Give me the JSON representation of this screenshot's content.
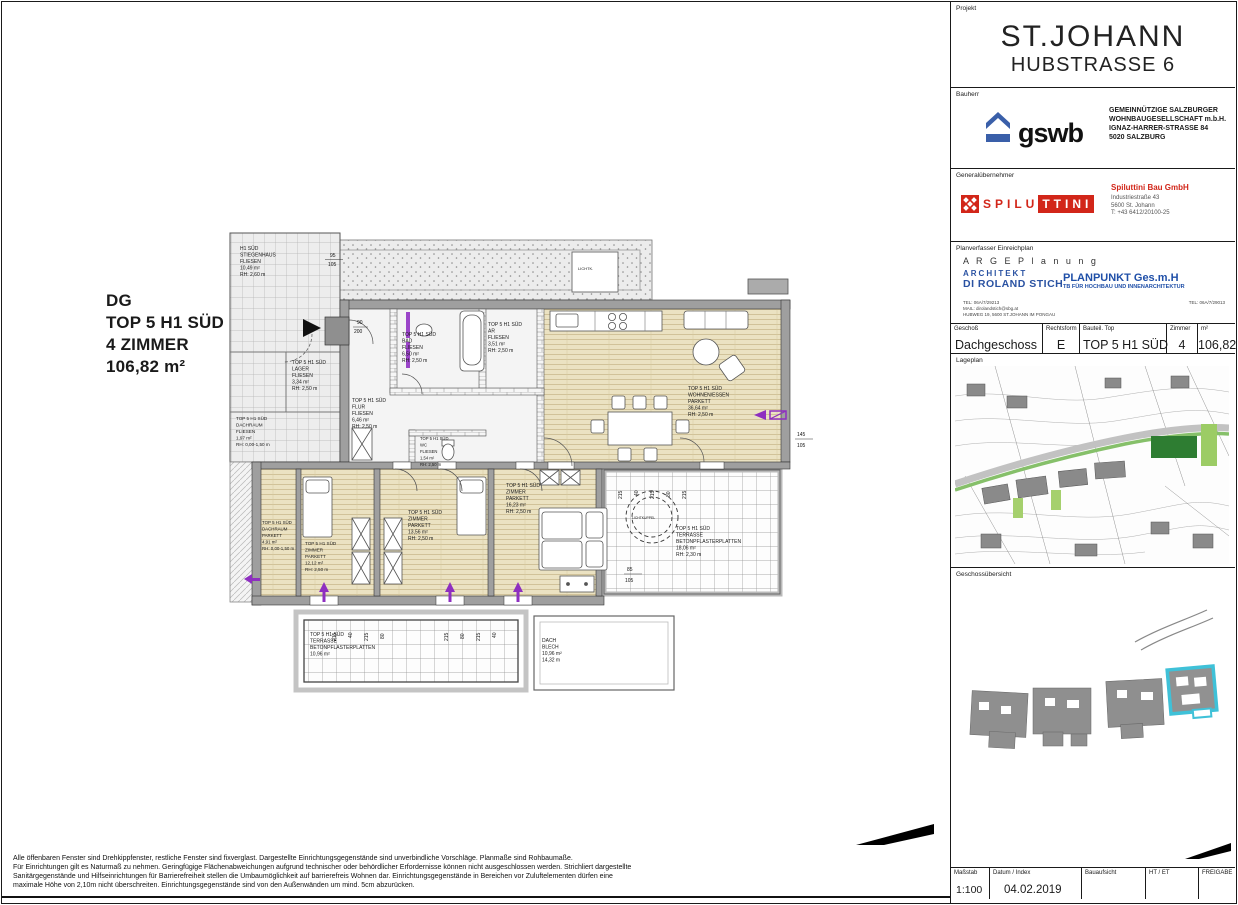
{
  "sheet": {
    "projekt": {
      "label": "Projekt",
      "title": "ST.JOHANN",
      "subtitle": "HUBSTRASSE 6"
    },
    "bauherr": {
      "label": "Bauherr",
      "logo": "gswb",
      "address": [
        "GEMEINNÜTZIGE SALZBURGER",
        "WOHNBAUGESELLSCHAFT m.b.H.",
        "IGNAZ-HARRER-STRASSE 84",
        "5020 SALZBURG"
      ]
    },
    "generaluebernehmer": {
      "label": "Generalübernehmer",
      "logo_left": "SPILU",
      "logo_right": "TTINI",
      "company": "Spiluttini Bau GmbH",
      "address": [
        "Industriestraße 43",
        "5600 St. Johann",
        "T: +43 6412/20100-25"
      ]
    },
    "planverfasser": {
      "label": "Planverfasser Einreichplan",
      "arge": "A R G E   P l a n u n g",
      "architekt": "ARCHITEKT",
      "architekt_name": "DI ROLAND STICH",
      "firma": "PLANPUNKT Ges.m.H",
      "firma_sub": "TB FÜR HOCHBAU UND INNENARCHITEKTUR",
      "kontakt_links": [
        "TEL: 06A/7/29213",
        "MAIL: dirolandstich@sbg.at",
        "HUBWEG 19, 5600 ST.JOHANN IM PONGAU"
      ],
      "kontakt_rechts": "TEL: 06A/7/29013"
    },
    "einheit_tabelle": {
      "spalten": [
        "Geschoß",
        "Rechtsform",
        "Bauteil. Top",
        "Zimmer",
        "m²"
      ],
      "zeile": [
        "Dachgeschoss",
        "E",
        "TOP 5 H1 SÜD",
        "4",
        "106,82"
      ]
    },
    "lageplan_label": "Lageplan",
    "uebersicht_label": "Geschossübersicht",
    "info_tabelle": {
      "spalten": [
        {
          "label": "Maßstab",
          "wert": "1:100"
        },
        {
          "label": "Datum / Index",
          "wert": "04.02.2019"
        },
        {
          "label": "Bauaufsicht",
          "wert": ""
        },
        {
          "label": "HT / ET",
          "wert": ""
        },
        {
          "label": "FREIGABE",
          "wert": ""
        }
      ]
    }
  },
  "plan_titel": {
    "zeilen": [
      "DG",
      "TOP 5 H1 SÜD",
      "4 ZIMMER",
      "106,82 m²"
    ]
  },
  "hinweis": {
    "zeilen": [
      "Alle öffenbaren Fenster sind Drehkippfenster, restliche Fenster sind fixverglast. Dargestellte Einrichtungsgegenstände sind unverbindliche Vorschläge. Planmaße sind Rohbaumaße.",
      "Für Einrichtungen gilt es Naturmaß zu nehmen. Geringfügige Flächenabweichungen aufgrund technischer oder behördlicher Erfordernisse können nicht ausgeschlossen werden. Strichliert dargestellte",
      "Sanitärgegenstände und Hilfseinrichtungen für Barrierefreiheit stellen die Umbaumöglichkeit auf barrierefreis Wohnen dar. Einrichtungsgegenstände in Bereichen vor Zuluftelementen dürfen eine",
      "maximale Höhe von 2,10m nicht überschreiten. Einrichtungsgegenstände sind von den Außenwänden um mind. 5cm abzurücken."
    ]
  },
  "farben": {
    "wand": "#9f9f9f",
    "parkett": "#ebe2c2",
    "blau": "#1f4fa8",
    "rot": "#d22619",
    "violett": "#8e2fc0",
    "highlight_cyan": "#3fc1d8"
  },
  "plan": {
    "rooms": [
      {
        "x": 240,
        "y": 250,
        "lines": [
          "H1 SÜD",
          "STIEGENHAUS",
          "FLIESEN",
          "10,49 m²",
          "RH: 2,60 m"
        ]
      },
      {
        "x": 292,
        "y": 364,
        "lines": [
          "TOP 5 H1 SÜD",
          "LAGER",
          "FLIESEN",
          "3,34 m²",
          "RH: 2,50 m"
        ]
      },
      {
        "x": 236,
        "y": 420,
        "fs": 4.6,
        "lines": [
          "TOP 5 H1 SÜD",
          "DACHRAUM",
          "FLIESEN",
          "1,97 m²",
          "RH: 0,00-1,50 m"
        ]
      },
      {
        "x": 402,
        "y": 336,
        "lines": [
          "TOP 5 H1 SÜD",
          "BAD",
          "FLIESEN",
          "6,50 m²",
          "RH: 2,50 m"
        ]
      },
      {
        "x": 488,
        "y": 326,
        "lines": [
          "TOP 5 H1 SÜD",
          "AR",
          "FLIESEN",
          "3,51 m²",
          "RH: 2,50 m"
        ]
      },
      {
        "x": 352,
        "y": 402,
        "lines": [
          "TOP 5 H1 SÜD",
          "FLUR",
          "FLIESEN",
          "6,46 m²",
          "RH: 2,50 m"
        ]
      },
      {
        "x": 420,
        "y": 440,
        "fs": 4.2,
        "lines": [
          "TOP 5 H1 SÜD",
          "WC",
          "FLIESEN",
          "1,54 m²",
          "RH: 2,50 m"
        ]
      },
      {
        "x": 688,
        "y": 390,
        "lines": [
          "TOP 5 H1 SÜD",
          "WOHNEN/ESSEN",
          "PARKETT",
          "36,64 m²",
          "RH: 2,50 m"
        ]
      },
      {
        "x": 262,
        "y": 524,
        "fs": 4.4,
        "lines": [
          "TOP 5 H1 SÜD",
          "DACHRAUM",
          "PARKETT",
          "4,91 m²",
          "RH: 0,00-1,50 m"
        ]
      },
      {
        "x": 305,
        "y": 545,
        "fs": 4.6,
        "lines": [
          "TOP 5 H1 SÜD",
          "ZIMMER",
          "PARKETT",
          "12,12 m²",
          "RH: 2,50 m"
        ]
      },
      {
        "x": 408,
        "y": 514,
        "lines": [
          "TOP 5 H1 SÜD",
          "ZIMMER",
          "PARKETT",
          "13,56 m²",
          "RH: 2,50 m"
        ]
      },
      {
        "x": 506,
        "y": 487,
        "lines": [
          "TOP 5 H1 SÜD",
          "ZIMMER",
          "PARKETT",
          "16,23 m²",
          "RH: 2,50 m"
        ]
      },
      {
        "x": 676,
        "y": 530,
        "lines": [
          "TOP 5 H1 SÜD",
          "TERRASSE",
          "BETONPFLASTERPLATTEN",
          "18,06 m²",
          "RH: 2,30 m"
        ]
      },
      {
        "x": 310,
        "y": 636,
        "lines": [
          "TOP 5 H1 SÜD",
          "TERRASSE",
          "BETONPFLASTERPLATTEN",
          "10,96 m²"
        ]
      },
      {
        "x": 542,
        "y": 642,
        "lines": [
          "DACH",
          "BLECH",
          "10,96 m²",
          "14,32 m"
        ]
      },
      {
        "x": 632,
        "y": 519,
        "fs": 3.4,
        "lines": [
          "LICHTKUPPEL"
        ]
      },
      {
        "x": 578,
        "y": 270,
        "fs": 4,
        "lines": [
          "LICHTK."
        ]
      }
    ],
    "dims": [
      {
        "t": "95",
        "x": 330,
        "y": 257
      },
      {
        "t": "105",
        "x": 328,
        "y": 266
      },
      {
        "t": "145",
        "x": 797,
        "y": 436
      },
      {
        "t": "105",
        "x": 797,
        "y": 447
      },
      {
        "t": "85",
        "x": 627,
        "y": 571
      },
      {
        "t": "105",
        "x": 625,
        "y": 582
      },
      {
        "t": "90",
        "x": 357,
        "y": 324
      },
      {
        "t": "200",
        "x": 354,
        "y": 333
      },
      {
        "t": "215",
        "x": 336,
        "y": 641,
        "r": true
      },
      {
        "t": "40",
        "x": 352,
        "y": 638,
        "r": true
      },
      {
        "t": "215",
        "x": 368,
        "y": 641,
        "r": true
      },
      {
        "t": "80",
        "x": 384,
        "y": 639,
        "r": true
      },
      {
        "t": "215",
        "x": 448,
        "y": 641,
        "r": true
      },
      {
        "t": "80",
        "x": 464,
        "y": 639,
        "r": true
      },
      {
        "t": "215",
        "x": 480,
        "y": 641,
        "r": true
      },
      {
        "t": "40",
        "x": 496,
        "y": 638,
        "r": true
      },
      {
        "t": "215",
        "x": 622,
        "y": 499,
        "r": true
      },
      {
        "t": "40",
        "x": 638,
        "y": 496,
        "r": true
      },
      {
        "t": "215",
        "x": 654,
        "y": 499,
        "r": true
      },
      {
        "t": "80",
        "x": 670,
        "y": 497,
        "r": true
      },
      {
        "t": "215",
        "x": 686,
        "y": 499,
        "r": true
      },
      {
        "t": "0",
        "x": 775,
        "y": 882,
        "fs": 4
      },
      {
        "t": "1",
        "x": 806,
        "y": 882,
        "fs": 4
      },
      {
        "t": "2",
        "x": 837,
        "y": 882,
        "fs": 4
      },
      {
        "t": "3",
        "x": 869,
        "y": 882,
        "fs": 4
      },
      {
        "t": "4",
        "x": 900,
        "y": 882,
        "fs": 4
      },
      {
        "t": "5",
        "x": 931,
        "y": 882,
        "fs": 4
      }
    ]
  }
}
